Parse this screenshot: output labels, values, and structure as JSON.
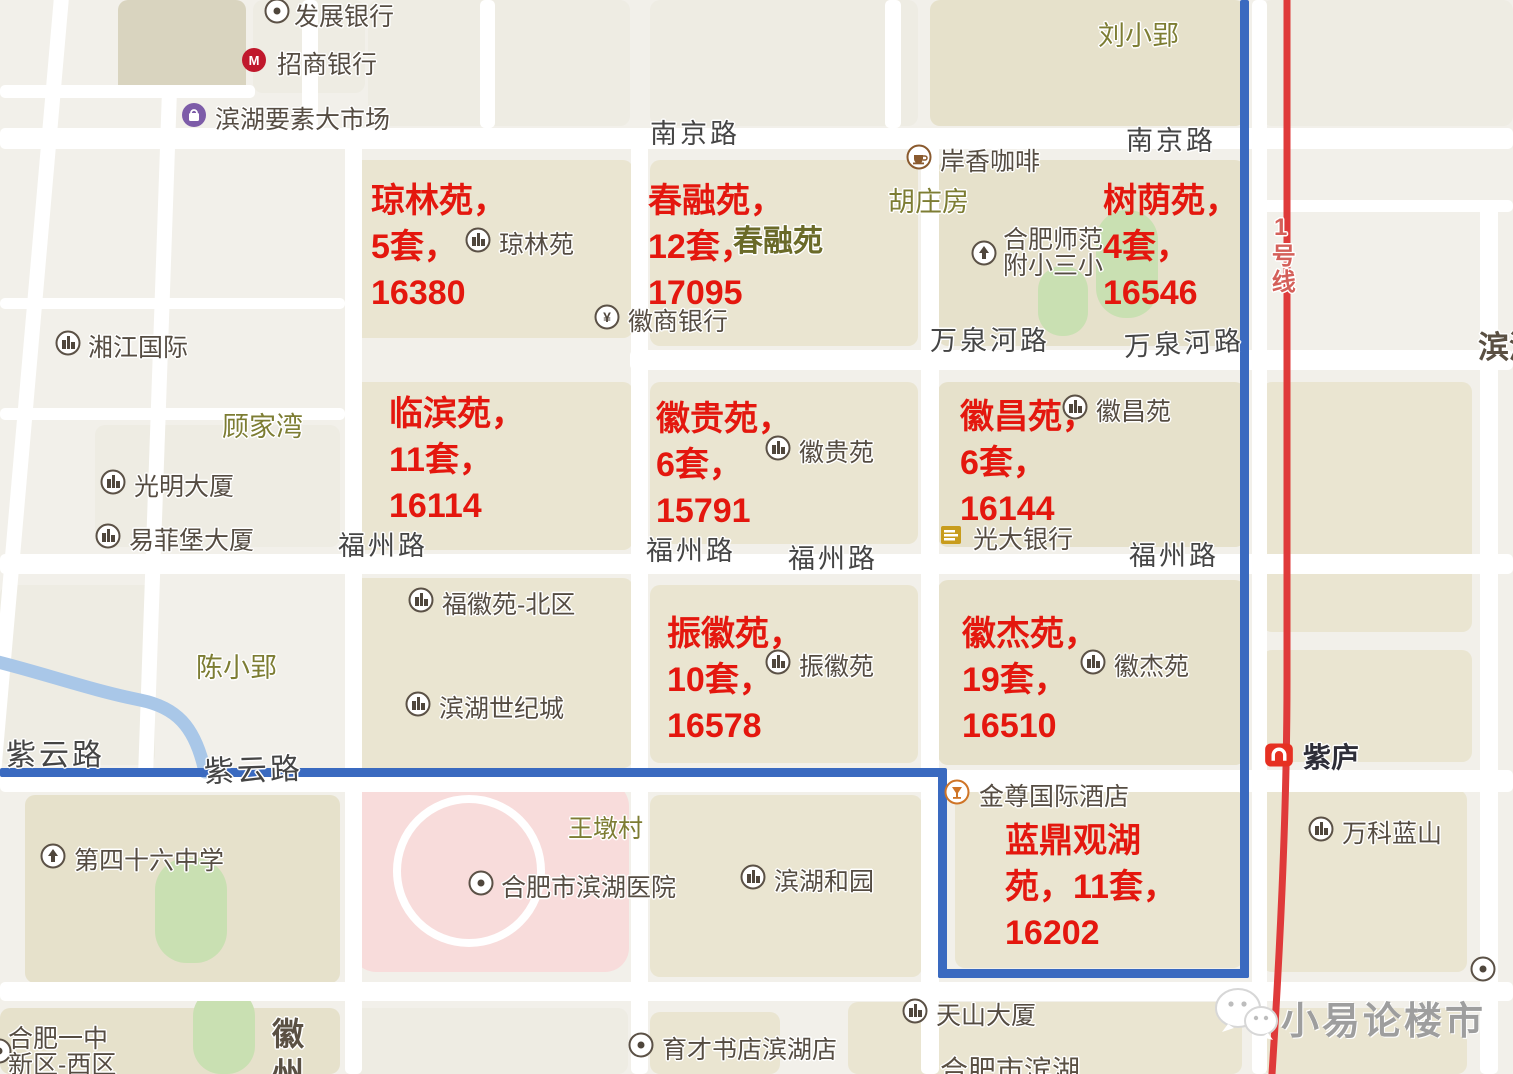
{
  "title": "合肥滨湖二手房成交地图（小易论楼市）",
  "colors": {
    "bg": "#f2f0ea",
    "road": "#ffffff",
    "block_khaki": "#eae5d1",
    "block_tan": "#e6e1cb",
    "block_dark": "#d9d4bf",
    "block_light": "#eeece3",
    "green": "#c9e0b2",
    "pink": "#f8dcdb",
    "river": "#a9c7e8",
    "boundary": "#3a6ac0",
    "metro_line": "#df3a3a",
    "metro_label": "#d4605a",
    "annotation_red": "#e4170e",
    "poi_text": "#554c42",
    "poi_ring": "#5b5146",
    "poi_glyph": "#4f463c",
    "road_label": "#454545",
    "olive_label": "#7d7d33",
    "estate_olive": "#6a6a28",
    "dark_partial": "#5a5043",
    "cmb_red": "#c0182c",
    "bag_purple": "#7d5ca8",
    "coffee_brown": "#8a5a2e",
    "hotel_orange": "#cf7426",
    "everbright_gold": "#c89c1c",
    "metro_logo_red": "#e63022",
    "watermark_gray": "#9e9e9e"
  },
  "map": {
    "blocks": [
      {
        "x": 118,
        "y": 0,
        "w": 128,
        "h": 96,
        "c": "block_dark"
      },
      {
        "x": 253,
        "y": 0,
        "w": 112,
        "h": 93,
        "c": "block_light"
      },
      {
        "x": 368,
        "y": 0,
        "w": 262,
        "h": 126,
        "c": "block_light"
      },
      {
        "x": 650,
        "y": 0,
        "w": 268,
        "h": 126,
        "c": "block_light"
      },
      {
        "x": 930,
        "y": 0,
        "w": 315,
        "h": 126,
        "c": "block_tan"
      },
      {
        "x": 1262,
        "y": 0,
        "w": 251,
        "h": 126,
        "c": "block_light"
      },
      {
        "x": 345,
        "y": 160,
        "w": 288,
        "h": 178,
        "c": "block_khaki"
      },
      {
        "x": 650,
        "y": 160,
        "w": 268,
        "h": 186,
        "c": "block_khaki"
      },
      {
        "x": 938,
        "y": 160,
        "w": 307,
        "h": 186,
        "c": "block_tan"
      },
      {
        "x": 95,
        "y": 425,
        "w": 245,
        "h": 122,
        "c": "block_light"
      },
      {
        "x": 0,
        "y": 585,
        "w": 155,
        "h": 180,
        "c": "block_light"
      },
      {
        "x": 345,
        "y": 382,
        "w": 288,
        "h": 168,
        "c": "block_khaki"
      },
      {
        "x": 650,
        "y": 382,
        "w": 268,
        "h": 162,
        "c": "block_khaki"
      },
      {
        "x": 938,
        "y": 382,
        "w": 307,
        "h": 165,
        "c": "block_tan"
      },
      {
        "x": 1262,
        "y": 382,
        "w": 210,
        "h": 250,
        "c": "block_khaki"
      },
      {
        "x": 345,
        "y": 578,
        "w": 288,
        "h": 190,
        "c": "block_khaki"
      },
      {
        "x": 650,
        "y": 585,
        "w": 268,
        "h": 178,
        "c": "block_khaki"
      },
      {
        "x": 938,
        "y": 580,
        "w": 307,
        "h": 185,
        "c": "block_tan"
      },
      {
        "x": 1262,
        "y": 650,
        "w": 210,
        "h": 112,
        "c": "block_khaki"
      },
      {
        "x": 25,
        "y": 795,
        "w": 315,
        "h": 188,
        "c": "block_tan"
      },
      {
        "x": 650,
        "y": 795,
        "w": 272,
        "h": 182,
        "c": "block_khaki"
      },
      {
        "x": 955,
        "y": 790,
        "w": 288,
        "h": 178,
        "c": "block_khaki"
      },
      {
        "x": 1262,
        "y": 790,
        "w": 205,
        "h": 182,
        "c": "block_khaki"
      },
      {
        "x": 0,
        "y": 1008,
        "w": 340,
        "h": 66,
        "c": "block_tan"
      },
      {
        "x": 352,
        "y": 1008,
        "w": 276,
        "h": 66,
        "c": "block_light"
      },
      {
        "x": 650,
        "y": 1012,
        "w": 130,
        "h": 62,
        "c": "block_khaki"
      },
      {
        "x": 848,
        "y": 1002,
        "w": 394,
        "h": 72,
        "c": "block_khaki"
      },
      {
        "x": 1262,
        "y": 1008,
        "w": 205,
        "h": 66,
        "c": "block_khaki"
      }
    ],
    "pink_area": {
      "x": 352,
      "y": 782,
      "w": 277,
      "h": 190,
      "r": 24
    },
    "hospital_ring": {
      "x": 393,
      "y": 795,
      "w": 152,
      "h": 152
    },
    "greens": [
      {
        "x": 1096,
        "y": 210,
        "w": 62,
        "h": 108,
        "r": 30
      },
      {
        "x": 1038,
        "y": 266,
        "w": 50,
        "h": 70,
        "r": 24
      },
      {
        "x": 155,
        "y": 858,
        "w": 72,
        "h": 105,
        "r": 32
      },
      {
        "x": 193,
        "y": 988,
        "w": 62,
        "h": 86,
        "r": 28
      }
    ],
    "roads_h": [
      {
        "x": 0,
        "y": 85,
        "w": 255,
        "h": 13
      },
      {
        "x": 0,
        "y": 128,
        "w": 1513,
        "h": 21
      },
      {
        "x": 0,
        "y": 298,
        "w": 345,
        "h": 11
      },
      {
        "x": 630,
        "y": 350,
        "w": 883,
        "h": 20
      },
      {
        "x": 0,
        "y": 408,
        "w": 345,
        "h": 12
      },
      {
        "x": 0,
        "y": 554,
        "w": 1513,
        "h": 20
      },
      {
        "x": 0,
        "y": 770,
        "w": 1513,
        "h": 22
      },
      {
        "x": 0,
        "y": 982,
        "w": 1513,
        "h": 19
      },
      {
        "x": 1262,
        "y": 200,
        "w": 251,
        "h": 12
      }
    ],
    "roads_v": [
      {
        "x": 55,
        "y": -15,
        "w": 15,
        "h": 800,
        "rot": 5
      },
      {
        "x": 162,
        "y": 90,
        "w": 15,
        "h": 690,
        "rot": 2
      },
      {
        "x": 302,
        "y": 0,
        "w": 16,
        "h": 130
      },
      {
        "x": 480,
        "y": 0,
        "w": 15,
        "h": 128
      },
      {
        "x": 885,
        "y": 0,
        "w": 16,
        "h": 128
      },
      {
        "x": 345,
        "y": 128,
        "w": 17,
        "h": 946
      },
      {
        "x": 631,
        "y": 128,
        "w": 17,
        "h": 946
      },
      {
        "x": 921,
        "y": 140,
        "w": 18,
        "h": 934
      },
      {
        "x": 1252,
        "y": 0,
        "w": 15,
        "h": 1074
      },
      {
        "x": 1480,
        "y": 205,
        "w": 18,
        "h": 869
      }
    ],
    "river_path": "M -10,660 C 40,672 90,690 140,700 C 175,707 195,725 205,772",
    "boundary_segments": [
      {
        "x": 1240,
        "y": 0,
        "w": 9,
        "h": 978
      },
      {
        "x": 938,
        "y": 969,
        "w": 311,
        "h": 9
      },
      {
        "x": 938,
        "y": 770,
        "w": 9,
        "h": 208
      },
      {
        "x": 0,
        "y": 768,
        "w": 947,
        "h": 9
      }
    ],
    "metro": {
      "line_path": "M 1287,0 L 1287,680 C 1287,800 1280,950 1272,1074",
      "line_width": 7,
      "label": {
        "text": "1号线",
        "x": 1268,
        "y": 214
      },
      "station": {
        "name": "紫庐",
        "icon_x": 1264,
        "icon_y": 740,
        "text_x": 1303,
        "text_y": 743
      }
    },
    "road_labels": [
      {
        "text": "南京路",
        "x": 650,
        "y": 120
      },
      {
        "text": "南京路",
        "x": 1126,
        "y": 127
      },
      {
        "text": "万泉河路",
        "x": 930,
        "y": 327
      },
      {
        "text": "万泉河路",
        "x": 1124,
        "y": 333,
        "rot": -3
      },
      {
        "text": "福州路",
        "x": 338,
        "y": 532
      },
      {
        "text": "福州路",
        "x": 646,
        "y": 537
      },
      {
        "text": "福州路",
        "x": 788,
        "y": 545
      },
      {
        "text": "福州路",
        "x": 1129,
        "y": 542
      },
      {
        "text": "紫云路",
        "x": 6,
        "y": 740,
        "size": 30
      },
      {
        "text": "紫云路",
        "x": 204,
        "y": 757,
        "size": 30,
        "rot": -2
      }
    ],
    "area_labels": [
      {
        "text": "刘小郢",
        "x": 1098,
        "y": 22
      },
      {
        "text": "胡庄房",
        "x": 888,
        "y": 188
      },
      {
        "text": "顾家湾",
        "x": 222,
        "y": 413
      },
      {
        "text": "陈小郢",
        "x": 196,
        "y": 654
      },
      {
        "text": "王墩村",
        "x": 568,
        "y": 816,
        "size": 25
      },
      {
        "text": "春融苑",
        "x": 733,
        "y": 226,
        "size": 30,
        "bold": true,
        "estate": true
      }
    ],
    "partial_labels": [
      {
        "text": "滨湖",
        "x": 1478,
        "y": 332,
        "size": 31,
        "bold": true
      },
      {
        "text": "合肥市滨湖",
        "x": 940,
        "y": 1056,
        "size": 28
      },
      {
        "text": "徽",
        "x": 272,
        "y": 1018,
        "size": 32,
        "bold": true
      },
      {
        "text": "州",
        "x": 272,
        "y": 1058,
        "size": 32,
        "bold": true
      }
    ],
    "pois": [
      {
        "icon": "dot",
        "lines": [
          "发展银行"
        ],
        "ix": 264,
        "iy": -2,
        "tx": 294,
        "ty": 4
      },
      {
        "icon": "cmb",
        "lines": [
          "招商银行"
        ],
        "ix": 241,
        "iy": 47,
        "tx": 277,
        "ty": 52
      },
      {
        "icon": "bag",
        "lines": [
          "滨湖要素大市场"
        ],
        "ix": 181,
        "iy": 102,
        "tx": 215,
        "ty": 107
      },
      {
        "icon": "building",
        "lines": [
          "湘江国际"
        ],
        "ix": 55,
        "iy": 330,
        "tx": 88,
        "ty": 335
      },
      {
        "icon": "building",
        "lines": [
          "光明大厦"
        ],
        "ix": 100,
        "iy": 469,
        "tx": 134,
        "ty": 474
      },
      {
        "icon": "building",
        "lines": [
          "易菲堡大厦"
        ],
        "ix": 95,
        "iy": 523,
        "tx": 129,
        "ty": 528
      },
      {
        "icon": "building",
        "lines": [
          "琼林苑"
        ],
        "ix": 465,
        "iy": 227,
        "tx": 499,
        "ty": 232
      },
      {
        "icon": "yuan",
        "lines": [
          "徽商银行"
        ],
        "ix": 594,
        "iy": 304,
        "tx": 628,
        "ty": 309
      },
      {
        "icon": "coffee",
        "lines": [
          "岸香咖啡"
        ],
        "ix": 906,
        "iy": 144,
        "tx": 940,
        "ty": 149
      },
      {
        "icon": "school",
        "lines": [
          "合肥师范",
          "附小三小"
        ],
        "ix": 971,
        "iy": 240,
        "tx": 1003,
        "ty": 227
      },
      {
        "icon": "building",
        "lines": [
          "徽贵苑"
        ],
        "ix": 765,
        "iy": 435,
        "tx": 799,
        "ty": 440
      },
      {
        "icon": "building",
        "lines": [
          "徽昌苑"
        ],
        "ix": 1062,
        "iy": 394,
        "tx": 1096,
        "ty": 399
      },
      {
        "icon": "everbright",
        "lines": [
          "光大银行"
        ],
        "ix": 938,
        "iy": 522,
        "tx": 973,
        "ty": 527
      },
      {
        "icon": "building",
        "lines": [
          "福徽苑-北区"
        ],
        "ix": 408,
        "iy": 587,
        "tx": 442,
        "ty": 592
      },
      {
        "icon": "building",
        "lines": [
          "振徽苑"
        ],
        "ix": 765,
        "iy": 649,
        "tx": 799,
        "ty": 654
      },
      {
        "icon": "building",
        "lines": [
          "徽杰苑"
        ],
        "ix": 1080,
        "iy": 649,
        "tx": 1114,
        "ty": 654
      },
      {
        "icon": "building",
        "lines": [
          "滨湖世纪城"
        ],
        "ix": 405,
        "iy": 691,
        "tx": 439,
        "ty": 696
      },
      {
        "icon": "hotel",
        "lines": [
          "金尊国际酒店"
        ],
        "ix": 944,
        "iy": 779,
        "tx": 979,
        "ty": 784
      },
      {
        "icon": "building",
        "lines": [
          "滨湖和园"
        ],
        "ix": 740,
        "iy": 864,
        "tx": 774,
        "ty": 869
      },
      {
        "icon": "dot",
        "lines": [
          "合肥市滨湖医院"
        ],
        "ix": 468,
        "iy": 870,
        "tx": 501,
        "ty": 875
      },
      {
        "icon": "school",
        "lines": [
          "第四十六中学"
        ],
        "ix": 40,
        "iy": 843,
        "tx": 74,
        "ty": 848
      },
      {
        "icon": "building",
        "lines": [
          "天山大厦"
        ],
        "ix": 902,
        "iy": 998,
        "tx": 936,
        "ty": 1003
      },
      {
        "icon": "dot",
        "lines": [
          "育才书店滨湖店"
        ],
        "ix": 628,
        "iy": 1032,
        "tx": 662,
        "ty": 1037
      },
      {
        "icon": "building",
        "lines": [
          "万科蓝山"
        ],
        "ix": 1308,
        "iy": 816,
        "tx": 1342,
        "ty": 821
      },
      {
        "icon": "dot",
        "lines": [
          "合肥一中",
          "新区-西区"
        ],
        "ix": -14,
        "iy": 1038,
        "tx": 8,
        "ty": 1026
      },
      {
        "icon": "dot",
        "lines": [
          ""
        ],
        "ix": 1470,
        "iy": 956,
        "tx": 1500,
        "ty": 960
      }
    ],
    "annotations": [
      {
        "x": 371,
        "y": 178,
        "lines": [
          "琼林苑，",
          "5套，",
          "16380"
        ]
      },
      {
        "x": 648,
        "y": 178,
        "lines": [
          "春融苑，",
          "12套，",
          "17095"
        ]
      },
      {
        "x": 1103,
        "y": 178,
        "lines": [
          "树荫苑，",
          "4套，",
          "16546"
        ]
      },
      {
        "x": 389,
        "y": 391,
        "lines": [
          "临滨苑，",
          "11套，",
          "16114"
        ]
      },
      {
        "x": 656,
        "y": 396,
        "lines": [
          "徽贵苑，",
          "6套，",
          "15791"
        ]
      },
      {
        "x": 960,
        "y": 394,
        "lines": [
          "徽昌苑，",
          "6套，",
          "16144"
        ]
      },
      {
        "x": 667,
        "y": 611,
        "lines": [
          "振徽苑，",
          "10套，",
          "16578"
        ]
      },
      {
        "x": 962,
        "y": 611,
        "lines": [
          "徽杰苑，",
          "19套，",
          "16510"
        ]
      },
      {
        "x": 1005,
        "y": 818,
        "lines": [
          "蓝鼎观湖",
          "苑，11套，",
          "16202"
        ]
      }
    ],
    "annotation_font": 34,
    "annotation_lh": 46
  },
  "watermark": {
    "text": "小易论楼市",
    "x": 1281,
    "y": 990,
    "size": 38,
    "icon_x": 1212,
    "icon_y": 984
  }
}
